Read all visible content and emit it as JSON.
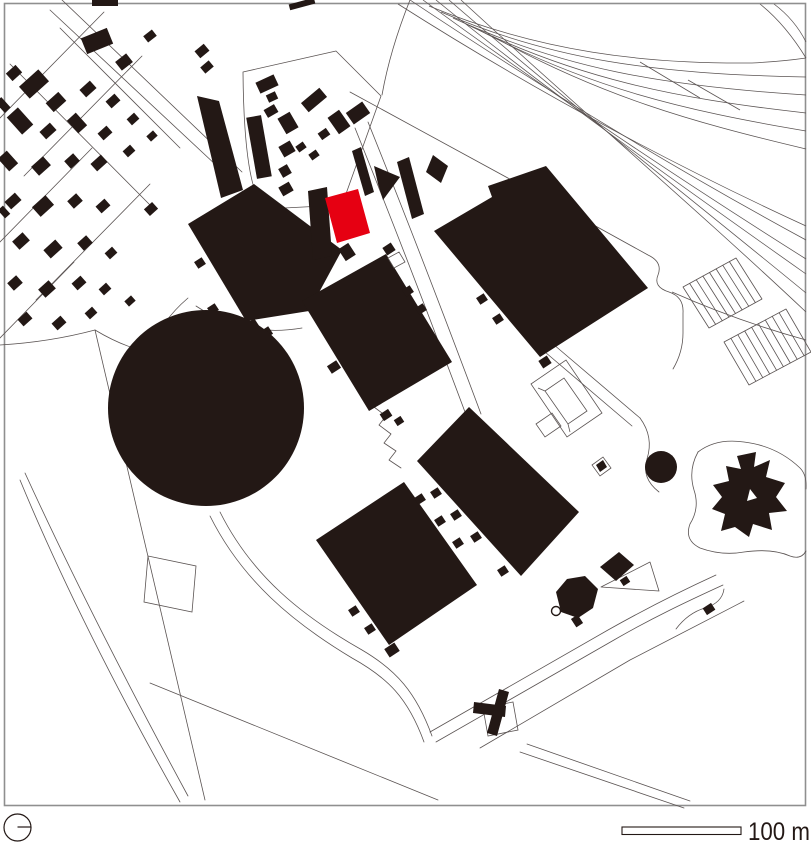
{
  "map": {
    "kind": "architectural figure-ground site plan",
    "scale_bar": {
      "label": "100 m"
    },
    "colors": {
      "building": "#231815",
      "highlight": "#e60012",
      "linework": "#5a5352",
      "frame": "#8f8f8f",
      "background": "#ffffff"
    },
    "symbols": {
      "north_indicator": "circle-with-tick",
      "highlighted_building": "red campus building"
    }
  }
}
